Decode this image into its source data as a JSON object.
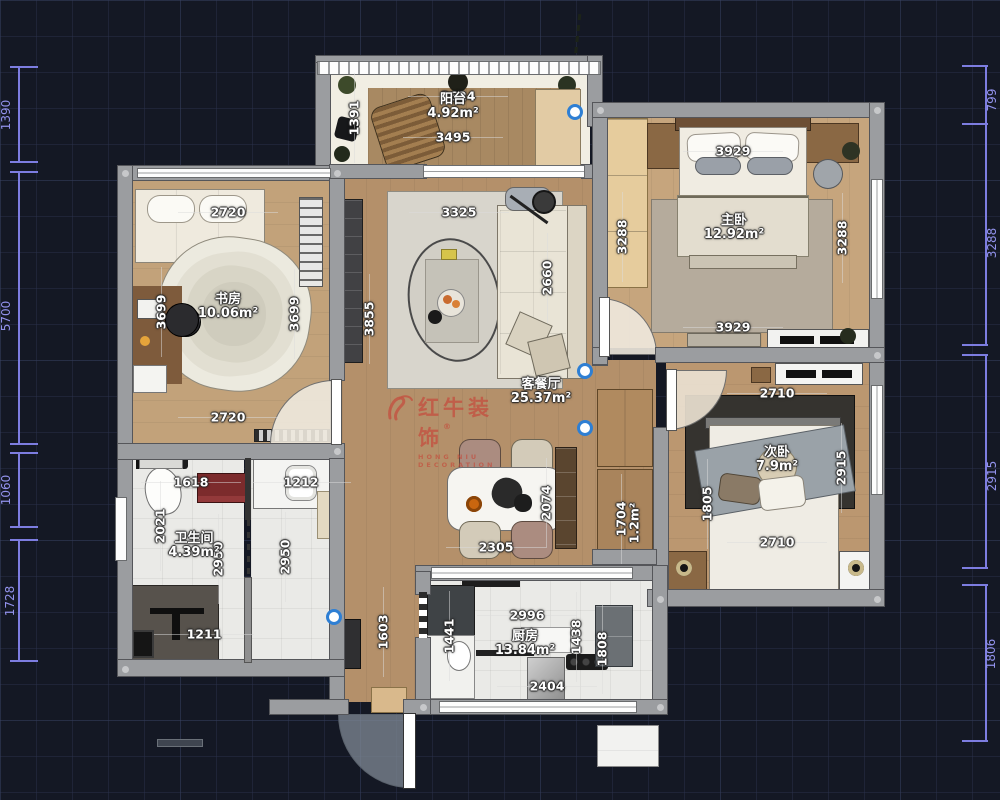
{
  "watermark": {
    "brand": "红牛装饰",
    "sub": "HONG NIU DECORATION",
    "symbol": "®"
  },
  "accents": {
    "dim_text": "#ffffff",
    "edge_dim": "#8f8fe8",
    "logo_red": "#c5483a",
    "grip_blue": "#2e7fd4"
  },
  "rooms": [
    {
      "name": "阳台",
      "area": "4.92m²",
      "x": 453,
      "y": 100
    },
    {
      "name": "书房",
      "area": "10.06m²",
      "x": 228,
      "y": 300
    },
    {
      "name": "客餐厅",
      "area": "25.37m²",
      "x": 541,
      "y": 385
    },
    {
      "name": "主卧",
      "area": "12.92m²",
      "x": 734,
      "y": 221
    },
    {
      "name": "次卧",
      "area": "7.9m²",
      "x": 777,
      "y": 453
    },
    {
      "name": "卫生间",
      "area": "4.39m²",
      "x": 194,
      "y": 539
    },
    {
      "name": "厨房",
      "area": "13.84m²",
      "x": 525,
      "y": 637
    }
  ],
  "dims": [
    {
      "t": "3624",
      "x": 458,
      "y": 96,
      "o": "h"
    },
    {
      "t": "3495",
      "x": 453,
      "y": 137,
      "o": "h"
    },
    {
      "t": "1391",
      "x": 354,
      "y": 118,
      "o": "v"
    },
    {
      "t": "2720",
      "x": 228,
      "y": 212,
      "o": "h"
    },
    {
      "t": "3699",
      "x": 161,
      "y": 312,
      "o": "v"
    },
    {
      "t": "3699",
      "x": 294,
      "y": 314,
      "o": "v"
    },
    {
      "t": "3855",
      "x": 369,
      "y": 319,
      "o": "v"
    },
    {
      "t": "2720",
      "x": 228,
      "y": 417,
      "o": "h"
    },
    {
      "t": "3325",
      "x": 459,
      "y": 212,
      "o": "h"
    },
    {
      "t": "2660",
      "x": 547,
      "y": 278,
      "o": "v"
    },
    {
      "t": "3288",
      "x": 622,
      "y": 237,
      "o": "v"
    },
    {
      "t": "3929",
      "x": 733,
      "y": 151,
      "o": "h"
    },
    {
      "t": "3288",
      "x": 842,
      "y": 238,
      "o": "v"
    },
    {
      "t": "3929",
      "x": 733,
      "y": 327,
      "o": "h"
    },
    {
      "t": "2710",
      "x": 777,
      "y": 393,
      "o": "h"
    },
    {
      "t": "2915",
      "x": 841,
      "y": 468,
      "o": "v"
    },
    {
      "t": "1805",
      "x": 707,
      "y": 504,
      "o": "v"
    },
    {
      "t": "2710",
      "x": 777,
      "y": 542,
      "o": "h"
    },
    {
      "t": "1704",
      "x": 621,
      "y": 519,
      "o": "v"
    },
    {
      "t": "1.2m²",
      "x": 634,
      "y": 523,
      "o": "v",
      "nl": 1
    },
    {
      "t": "2074",
      "x": 546,
      "y": 503,
      "o": "v"
    },
    {
      "t": "2305",
      "x": 496,
      "y": 547,
      "o": "h"
    },
    {
      "t": "1618",
      "x": 191,
      "y": 482,
      "o": "h"
    },
    {
      "t": "1212",
      "x": 301,
      "y": 482,
      "o": "h"
    },
    {
      "t": "2021",
      "x": 160,
      "y": 526,
      "o": "v"
    },
    {
      "t": "2950",
      "x": 218,
      "y": 559,
      "o": "v"
    },
    {
      "t": "2950",
      "x": 285,
      "y": 557,
      "o": "v"
    },
    {
      "t": "1211",
      "x": 204,
      "y": 634,
      "o": "h"
    },
    {
      "t": "2996",
      "x": 527,
      "y": 615,
      "o": "h"
    },
    {
      "t": "1441",
      "x": 449,
      "y": 636,
      "o": "v"
    },
    {
      "t": "1438",
      "x": 576,
      "y": 637,
      "o": "v"
    },
    {
      "t": "1808",
      "x": 602,
      "y": 649,
      "o": "v"
    },
    {
      "t": "2404",
      "x": 547,
      "y": 686,
      "o": "h"
    },
    {
      "t": "1603",
      "x": 383,
      "y": 632,
      "o": "v"
    }
  ],
  "edge_dims": [
    {
      "t": "1390",
      "x": 6,
      "y": 115
    },
    {
      "t": "5700",
      "x": 6,
      "y": 316
    },
    {
      "t": "1060",
      "x": 6,
      "y": 490
    },
    {
      "t": "1728",
      "x": 10,
      "y": 601
    },
    {
      "t": "799",
      "x": 992,
      "y": 100
    },
    {
      "t": "3288",
      "x": 992,
      "y": 243
    },
    {
      "t": "2915",
      "x": 992,
      "y": 476
    },
    {
      "t": "1806",
      "x": 991,
      "y": 654
    }
  ],
  "grips": [
    {
      "x": 575,
      "y": 112
    },
    {
      "x": 585,
      "y": 371
    },
    {
      "x": 585,
      "y": 428
    },
    {
      "x": 334,
      "y": 617
    }
  ]
}
